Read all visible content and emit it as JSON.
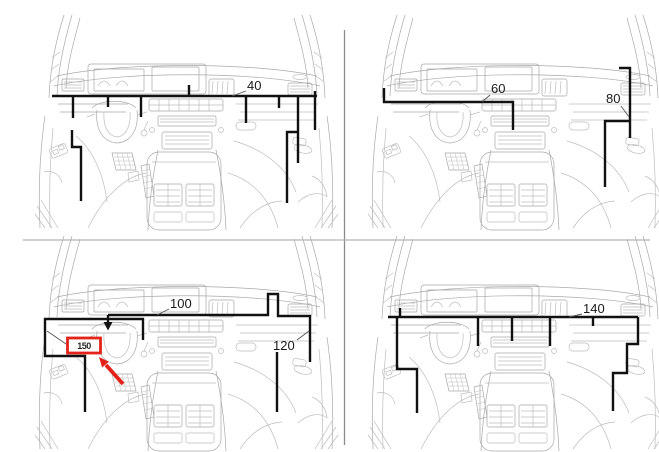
{
  "figure": {
    "title": "Vehicle dashboard harness routing diagram, four panels",
    "panels": [
      {
        "id": "top-left",
        "callouts": [
          {
            "label": "40"
          }
        ]
      },
      {
        "id": "top-right",
        "callouts": [
          {
            "label": "60"
          },
          {
            "label": "80"
          }
        ]
      },
      {
        "id": "bottom-left",
        "callouts": [
          {
            "label": "100"
          },
          {
            "label": "120"
          }
        ],
        "highlight": {
          "badge_label": "150"
        }
      },
      {
        "id": "bottom-right",
        "callouts": [
          {
            "label": "140"
          }
        ]
      }
    ],
    "icons": {
      "down_arrow": "black-down-locator-arrow",
      "red_arrow": "red-diagonal-pointer-arrow"
    },
    "colors": {
      "background": "#ffffff",
      "art_line": "#a9a9a9",
      "callout_line": "#111111",
      "divider_vertical": "#8a8a8a",
      "divider_horizontal": "#b3b3b3",
      "highlight_red": "#e3231a"
    }
  }
}
